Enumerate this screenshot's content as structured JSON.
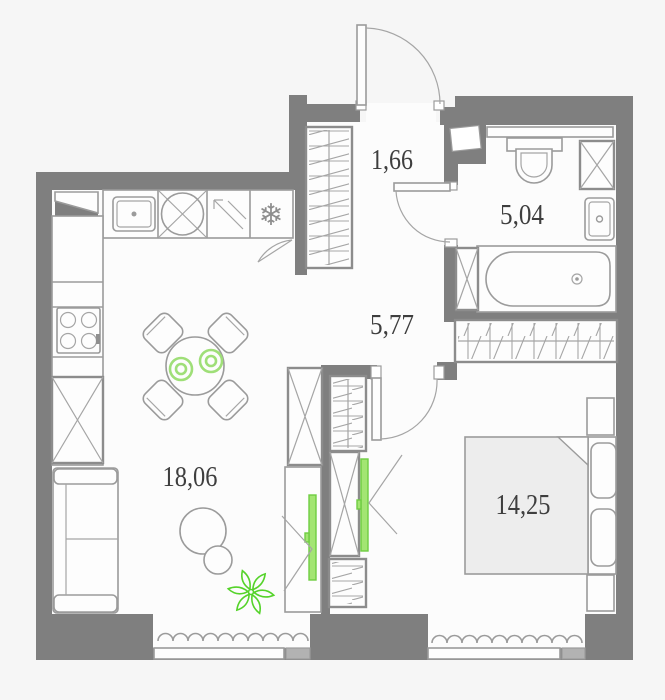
{
  "floor_plan": {
    "rooms": [
      {
        "name": "entrance-hall",
        "area": "1,66"
      },
      {
        "name": "bathroom",
        "area": "5,04"
      },
      {
        "name": "corridor",
        "area": "5,77"
      },
      {
        "name": "kitchen-living-room",
        "area": "18,06"
      },
      {
        "name": "bedroom",
        "area": "14,25"
      }
    ],
    "icons": {
      "fridge_snowflake": "❄"
    },
    "furniture": [
      "kitchen-sink",
      "hob",
      "pull-out-cabinet",
      "fridge",
      "stove",
      "sofa",
      "dining-table",
      "dining-chair",
      "pouf",
      "plant",
      "tv",
      "wardrobe",
      "toilet",
      "washing-machine",
      "washbasin",
      "bathtub",
      "bed",
      "pillow",
      "nightstand",
      "radiator",
      "window"
    ],
    "colors": {
      "wall": "#7f7f7f",
      "floor": "#fcfcfc",
      "background": "#f6f6f6",
      "furniture_outline": "#9b9b9b",
      "accent_green": "#6fcd42",
      "bed_fill": "#ededed",
      "window_block": "#b2b2b2",
      "label_text": "#3e3e3e"
    }
  }
}
